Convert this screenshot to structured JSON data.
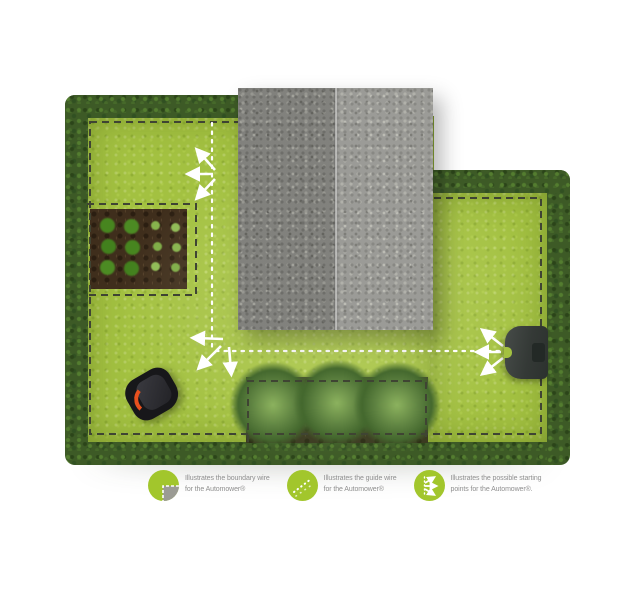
{
  "legend": {
    "items": [
      {
        "icon": "boundary-wire-icon",
        "line1": "Illustrates the boundary wire",
        "line2": "for the Automower®"
      },
      {
        "icon": "guide-wire-icon",
        "line1": "Illustrates the guide wire",
        "line2": "for the Automower®"
      },
      {
        "icon": "starting-points-icon",
        "line1": "Illustrates the possible starting",
        "line2": "points for the Automower®."
      }
    ],
    "icon_color": "#a2c62c"
  },
  "colors": {
    "lawn": "#a3c141",
    "hedge": "#3d5a26",
    "roof": "#90908b",
    "soil": "#3f2e1c",
    "boundary_wire": "#3f4433",
    "guide_wire": "#ffffff",
    "charging_station": "#343936",
    "mower_accent": "#e8501e",
    "legend_text": "#8f8f8f"
  }
}
